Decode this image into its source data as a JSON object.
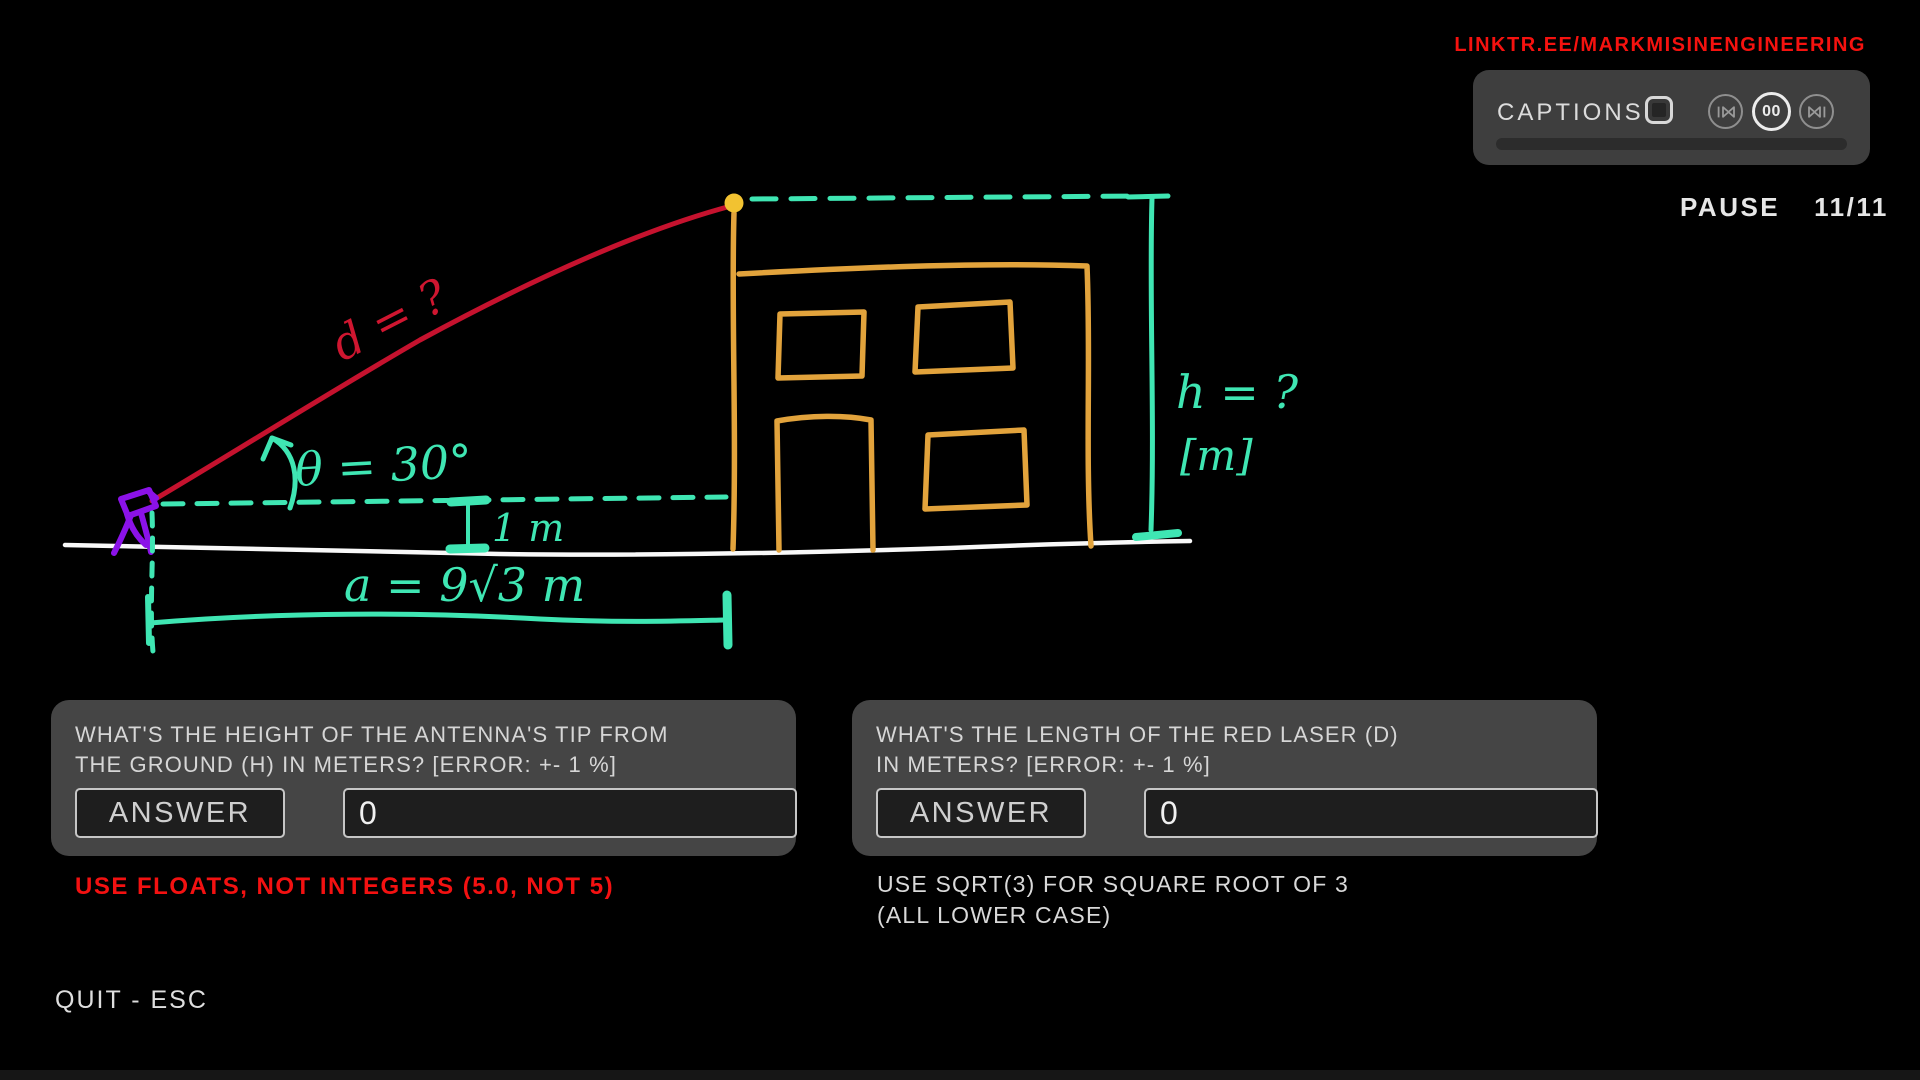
{
  "header": {
    "linktree_url": "LINKTR.EE/MARKMISINENGINEERING",
    "pause_label": "PAUSE",
    "question_counter": "11/11"
  },
  "captions_panel": {
    "captions_label": "CAPTIONS",
    "captions_enabled": false,
    "center_button_label": "00",
    "progress_percent": 0
  },
  "diagram": {
    "labels": {
      "laser_length": "d = ?",
      "angle": "θ = 30°",
      "building_height": "h = ?",
      "height_unit": "[m]",
      "antenna_ground_offset": "1 m",
      "horizontal_distance": "a = 9√3 m"
    },
    "colors": {
      "laser_red": "#c5122e",
      "dimension_teal": "#3fe6b3",
      "building_orange": "#e2a33c",
      "antenna_tip_yellow": "#f2c231",
      "laser_device_purple": "#8b12e8",
      "ground_white": "#f8f8f8"
    }
  },
  "questions": [
    {
      "prompt_line1": "WHAT'S THE HEIGHT OF THE ANTENNA'S TIP FROM",
      "prompt_line2": "THE GROUND (H) IN METERS? [ERROR: +- 1 %]",
      "answer_button_label": "ANSWER",
      "input_value": "0"
    },
    {
      "prompt_line1": "WHAT'S THE LENGTH OF THE RED LASER (D)",
      "prompt_line2": "IN METERS? [ERROR: +- 1 %]",
      "answer_button_label": "ANSWER",
      "input_value": "0"
    }
  ],
  "notes": {
    "floats_warning": "USE FLOATS, NOT INTEGERS (5.0, NOT 5)",
    "sqrt_hint_line1": "USE SQRT(3) FOR SQUARE ROOT OF 3",
    "sqrt_hint_line2": "(ALL LOWER CASE)"
  },
  "footer": {
    "quit_label": "QUIT - ESC"
  }
}
